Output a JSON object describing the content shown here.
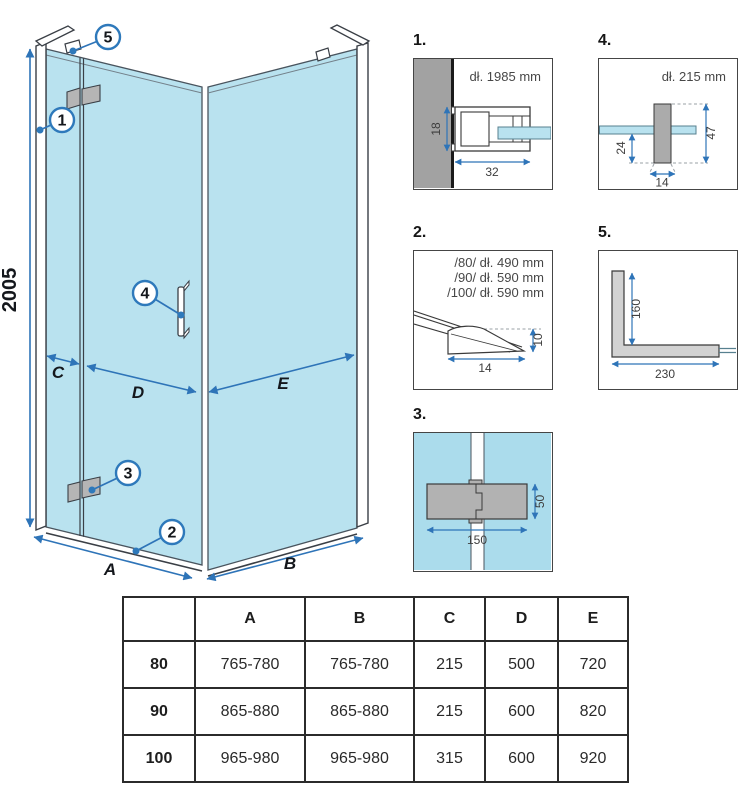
{
  "main": {
    "height_dim": "2005",
    "dim_a": "A",
    "dim_b": "B",
    "dim_c": "C",
    "dim_d": "D",
    "dim_e": "E",
    "callout_1": "1",
    "callout_2": "2",
    "callout_3": "3",
    "callout_4": "4",
    "callout_5": "5"
  },
  "details": {
    "d1": {
      "label": "1.",
      "length_note": "dł. 1985 mm",
      "dim_depth": "18",
      "dim_width": "32"
    },
    "d2": {
      "label": "2.",
      "length_notes": [
        "/80/ dł. 490 mm",
        "/90/ dł. 590 mm",
        "/100/ dł. 590 mm"
      ],
      "dim_width": "14",
      "dim_height": "10"
    },
    "d3": {
      "label": "3.",
      "dim_width": "150",
      "dim_height": "50"
    },
    "d4": {
      "label": "4.",
      "length_note": "dł. 215 mm",
      "dim_offset": "24",
      "dim_height": "47",
      "dim_width": "14"
    },
    "d5": {
      "label": "5.",
      "dim_vertical": "160",
      "dim_horizontal": "230"
    }
  },
  "table": {
    "headers": [
      "",
      "A",
      "B",
      "C",
      "D",
      "E"
    ],
    "rows": [
      {
        "cells": [
          "80",
          "765-780",
          "765-780",
          "215",
          "500",
          "720"
        ]
      },
      {
        "cells": [
          "90",
          "865-880",
          "865-880",
          "215",
          "600",
          "820"
        ]
      },
      {
        "cells": [
          "100",
          "965-980",
          "965-980",
          "315",
          "600",
          "920"
        ]
      }
    ]
  },
  "colors": {
    "glass_blue": "#b9e2ef",
    "dimension_blue": "#2e74b8",
    "callout_blue": "#2e79bb",
    "wall_grey": "#a2a2a2",
    "hinge_grey": "#b2b2b2",
    "line_dark": "#3a3f46"
  }
}
